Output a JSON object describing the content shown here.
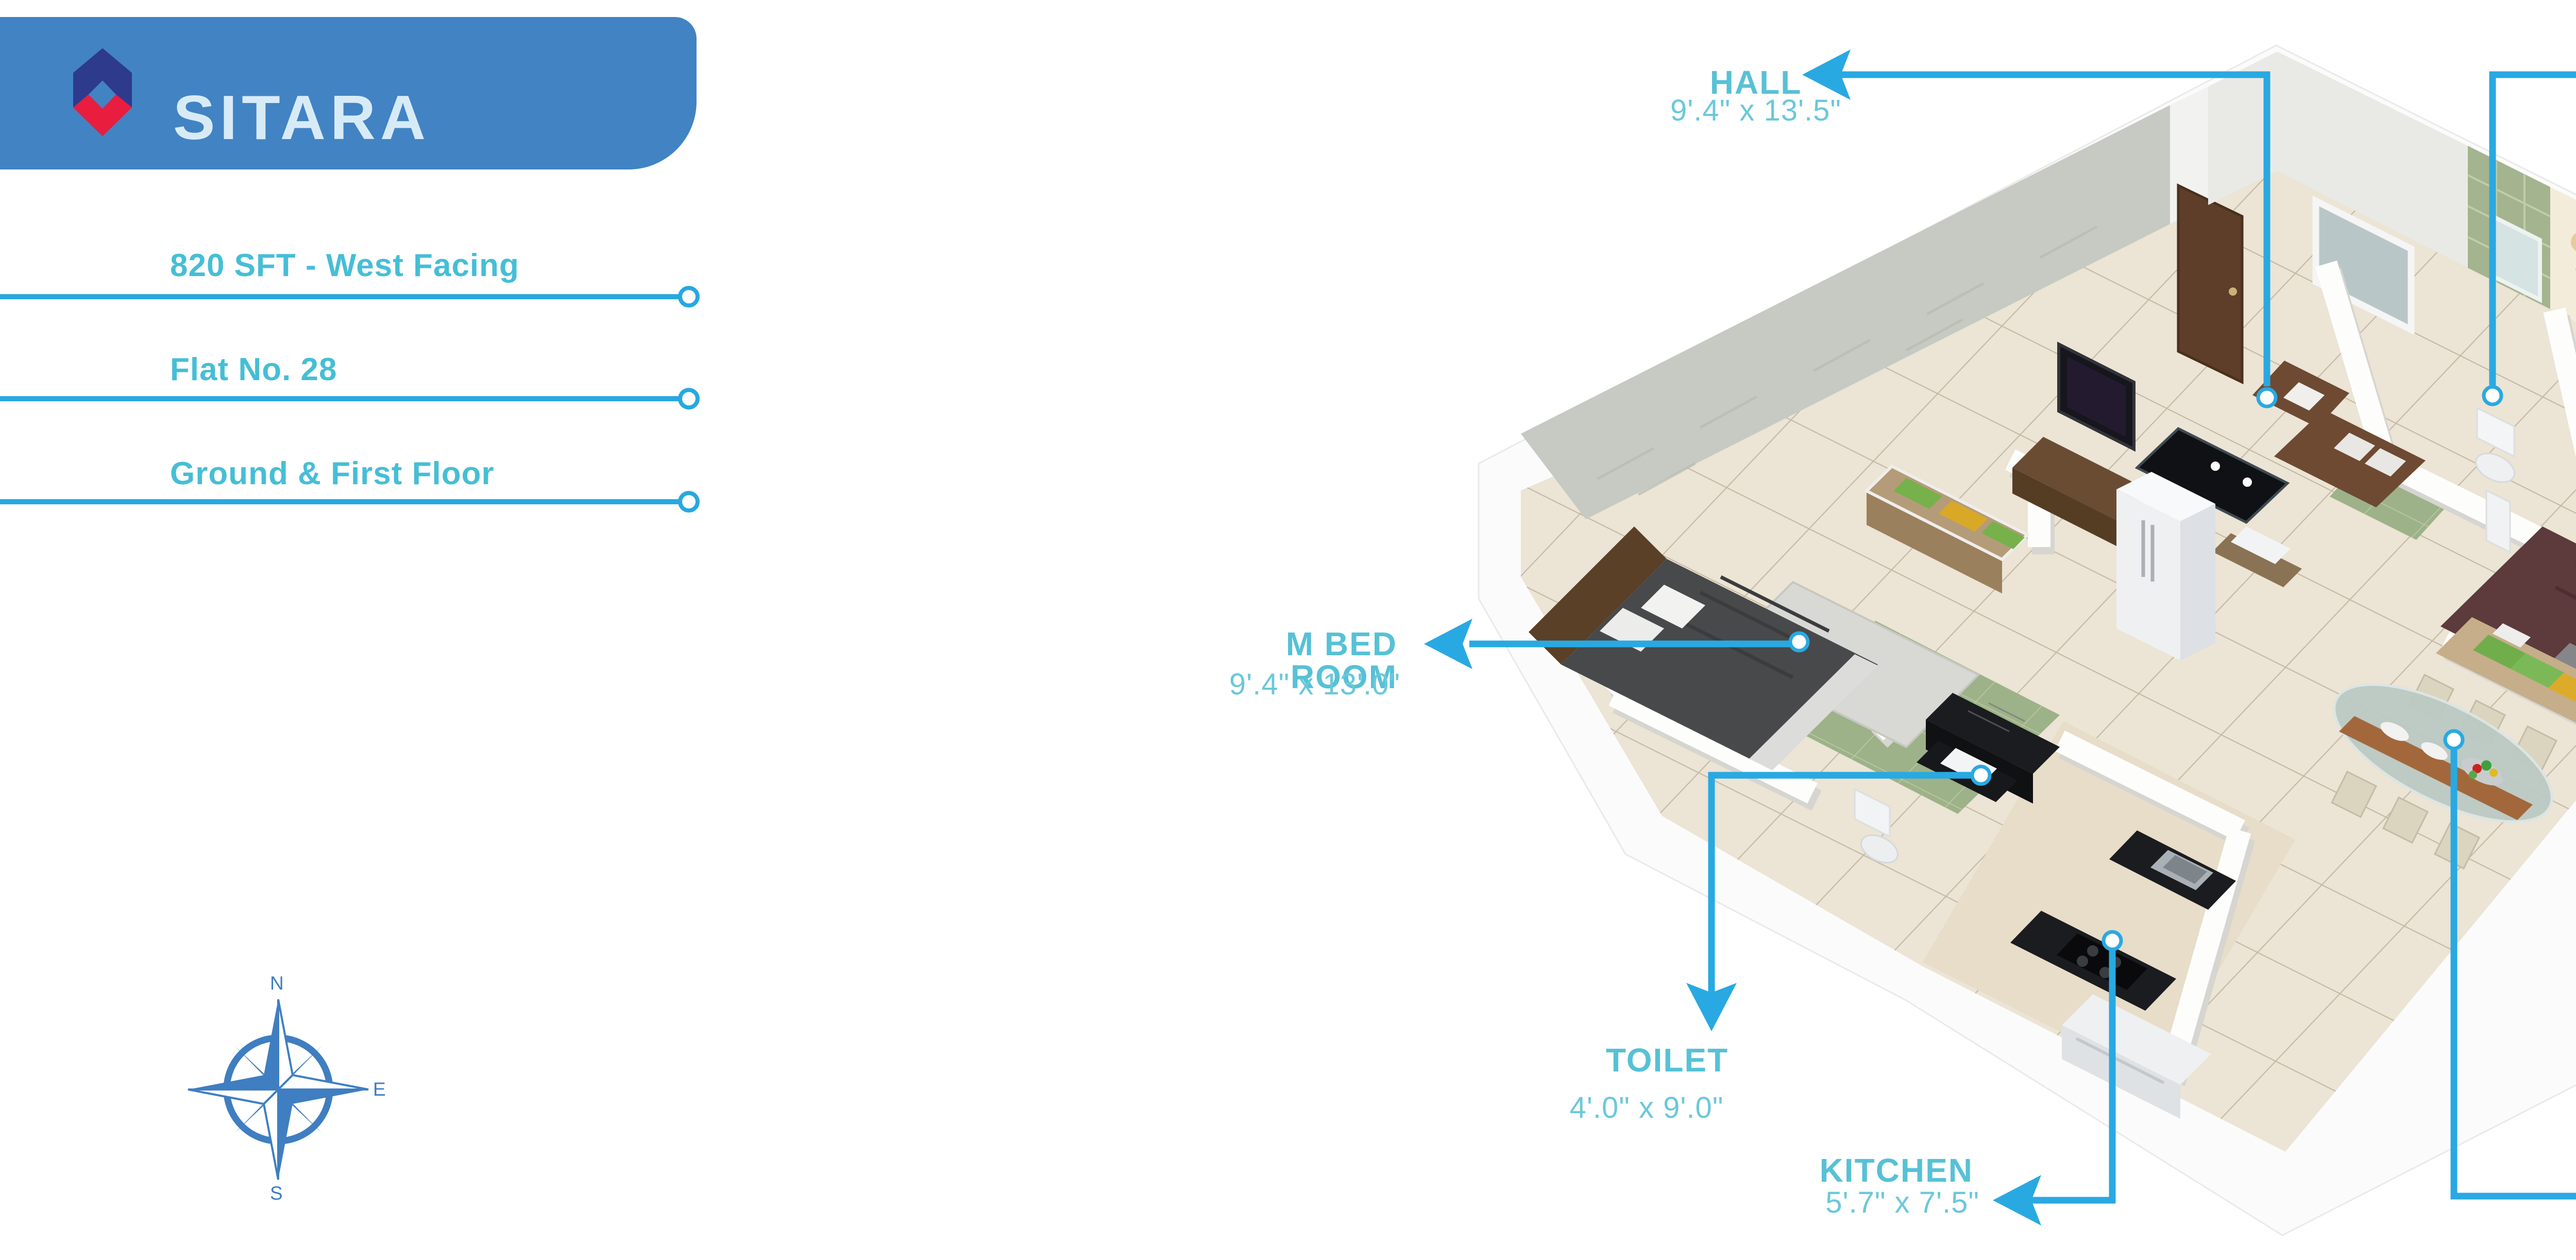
{
  "banner": {
    "title": "SITARA"
  },
  "details": {
    "area_facing": "820 SFT - West Facing",
    "flat_no": "Flat No. 28",
    "floors": "Ground & First Floor"
  },
  "compass": {
    "north": "N",
    "east": "E",
    "south": "S"
  },
  "rooms": {
    "hall": {
      "name": "HALL",
      "dims": "9'.4\" x 13'.5\""
    },
    "toilet_top": {
      "name": "TOILET",
      "dims": "3'.9\" x 7'.6\""
    },
    "m_bed_room": {
      "name": "M BED ROOM",
      "dims": "9'.4\" x 13'.0\""
    },
    "toilet_bottom": {
      "name": "TOILET",
      "dims": "4'.0\" x 9'.0\""
    },
    "kitchen": {
      "name": "KITCHEN",
      "dims": "5'.7\" x 7'.5\""
    },
    "c_bed_room": {
      "name": "C BED ROOM",
      "dims": "9'.0\" x 10'.0\""
    },
    "dining": {
      "name": "DINING",
      "dims": "13'.4\" x 8'.10\""
    }
  },
  "colors": {
    "accent_cyan": "#29A9E2",
    "label_teal": "#57C1D6",
    "banner_blue": "#4283C4",
    "logo_navy": "#2E3A8C",
    "logo_red": "#E91D3D",
    "compass_blue": "#3F7EC1"
  }
}
